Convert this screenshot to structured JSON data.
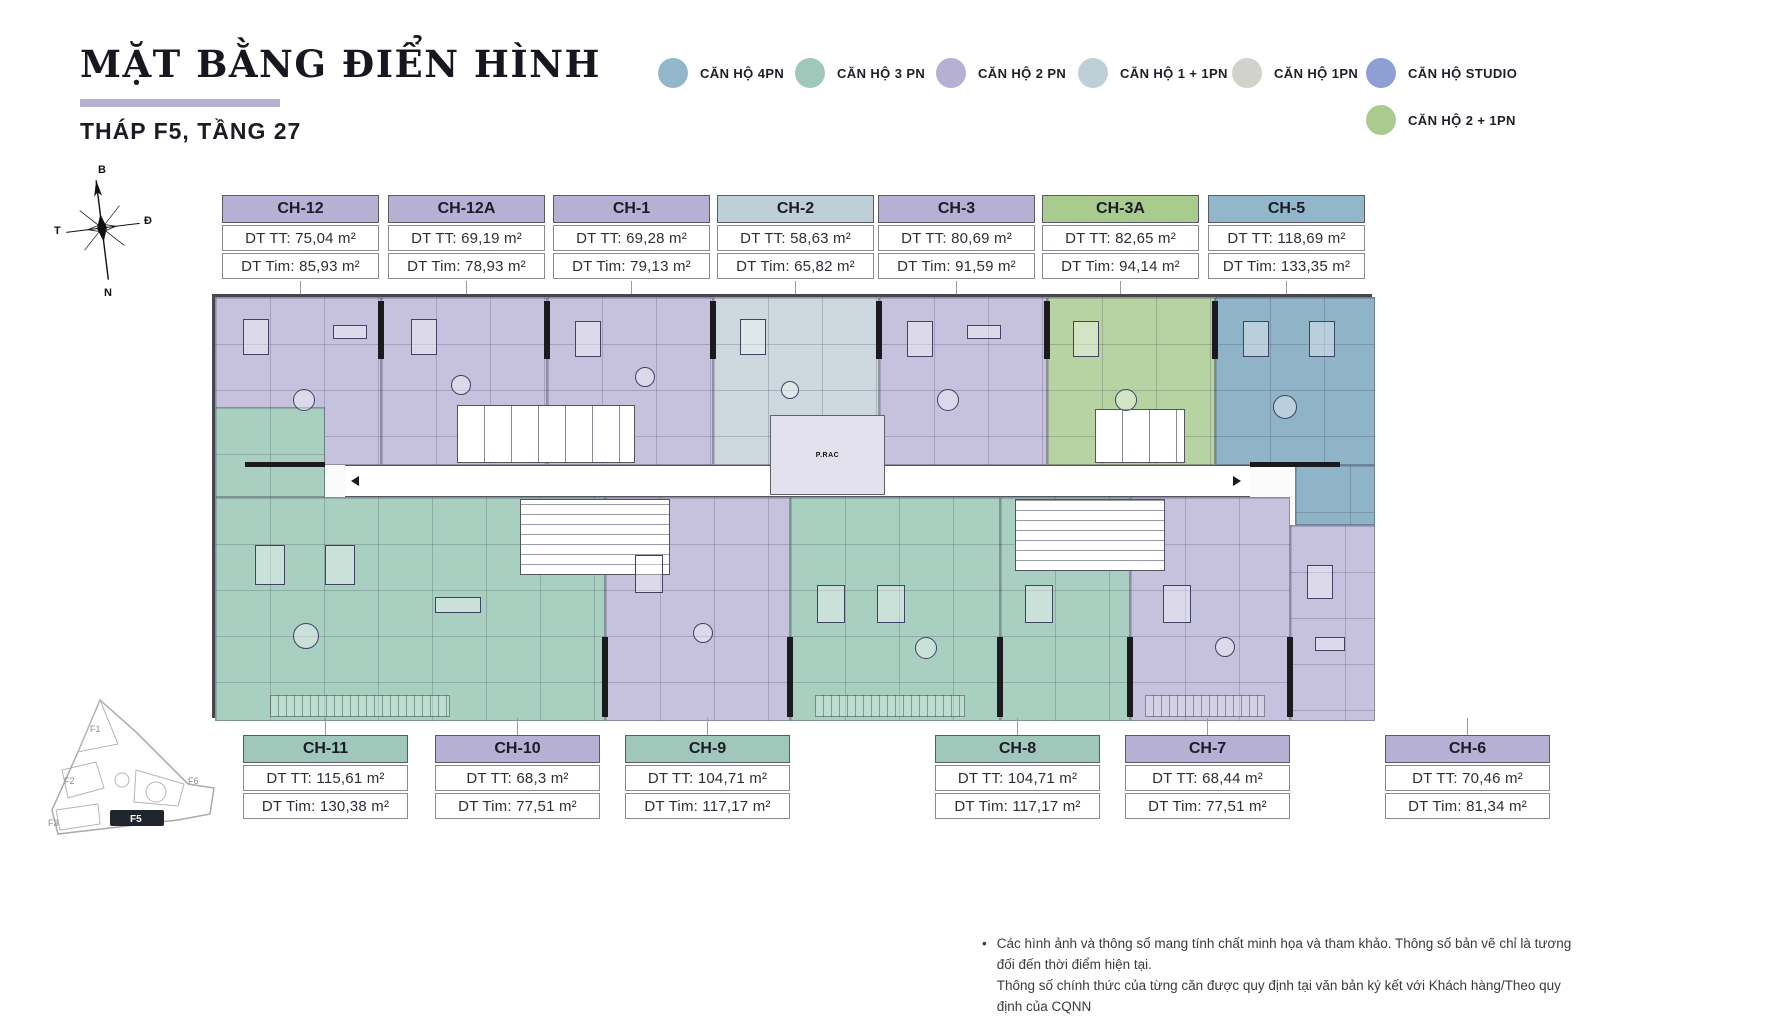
{
  "header": {
    "title": "MẶT BẰNG ĐIỂN HÌNH",
    "subtitle": "THÁP F5, TẦNG 27",
    "accent_color": "#b6b1d3"
  },
  "colors": {
    "pn4": "#92b7cb",
    "pn3": "#9fc8ba",
    "pn2": "#b5b0d4",
    "pn1_1": "#bfcfd8",
    "pn1": "#d2d2cc",
    "studio": "#8e9fd3",
    "pn2_1": "#a9cb8e",
    "fill_pn4": "#8fb4c7",
    "fill_pn3": "#a9cfc0",
    "fill_pn2": "#c6c2de",
    "fill_pn1_1": "#ccd8de",
    "fill_pn2_1": "#b8d3a2"
  },
  "legend": {
    "items": [
      {
        "label": "CĂN HỘ 4PN"
      },
      {
        "label": "CĂN HỘ 3 PN"
      },
      {
        "label": "CĂN HỘ 2 PN"
      },
      {
        "label": "CĂN HỘ 1 + 1PN"
      },
      {
        "label": "CĂN HỘ 1PN"
      },
      {
        "label": "CĂN HỘ STUDIO"
      },
      {
        "label": "CĂN HỘ 2 + 1PN"
      }
    ]
  },
  "compass": {
    "north": "B",
    "east": "Đ",
    "south": "N",
    "west": "T"
  },
  "units_top": [
    {
      "id": "CH-12",
      "tt": "DT TT: 75,04 m²",
      "tim": "DT Tim: 85,93 m²"
    },
    {
      "id": "CH-12A",
      "tt": "DT TT: 69,19 m²",
      "tim": "DT Tim: 78,93 m²"
    },
    {
      "id": "CH-1",
      "tt": "DT TT: 69,28 m²",
      "tim": "DT Tim: 79,13 m²"
    },
    {
      "id": "CH-2",
      "tt": "DT TT: 58,63 m²",
      "tim": "DT Tim: 65,82 m²"
    },
    {
      "id": "CH-3",
      "tt": "DT TT: 80,69 m²",
      "tim": "DT Tim: 91,59 m²"
    },
    {
      "id": "CH-3A",
      "tt": "DT TT: 82,65 m²",
      "tim": "DT Tim: 94,14 m²"
    },
    {
      "id": "CH-5",
      "tt": "DT TT: 118,69 m²",
      "tim": "DT Tim: 133,35 m²"
    }
  ],
  "units_bottom": [
    {
      "id": "CH-11",
      "tt": "DT TT: 115,61 m²",
      "tim": "DT Tim: 130,38 m²"
    },
    {
      "id": "CH-10",
      "tt": "DT TT: 68,3 m²",
      "tim": "DT Tim: 77,51 m²"
    },
    {
      "id": "CH-9",
      "tt": "DT TT: 104,71 m²",
      "tim": "DT Tim: 117,17 m²"
    },
    {
      "id": "CH-8",
      "tt": "DT TT: 104,71 m²",
      "tim": "DT Tim: 117,17 m²"
    },
    {
      "id": "CH-7",
      "tt": "DT TT: 68,44 m²",
      "tim": "DT Tim: 77,51 m²"
    },
    {
      "id": "CH-6",
      "tt": "DT TT: 70,46 m²",
      "tim": "DT Tim: 81,34 m²"
    }
  ],
  "plan": {
    "core_label": "P.RAC"
  },
  "minimap": {
    "highlight": "F5",
    "f1": "F1",
    "f2": "F2",
    "f3": "F3",
    "f6": "F6"
  },
  "disclaimer": {
    "bullet": "•",
    "line1": "Các hình ảnh và thông số mang tính chất minh họa và tham khảo. Thông số bản vẽ chỉ là tương đối đến thời điểm hiện tại.",
    "line2": "Thông số chính thức của từng căn được quy định tại văn bản ký kết với Khách hàng/Theo quy định của CQNN"
  }
}
